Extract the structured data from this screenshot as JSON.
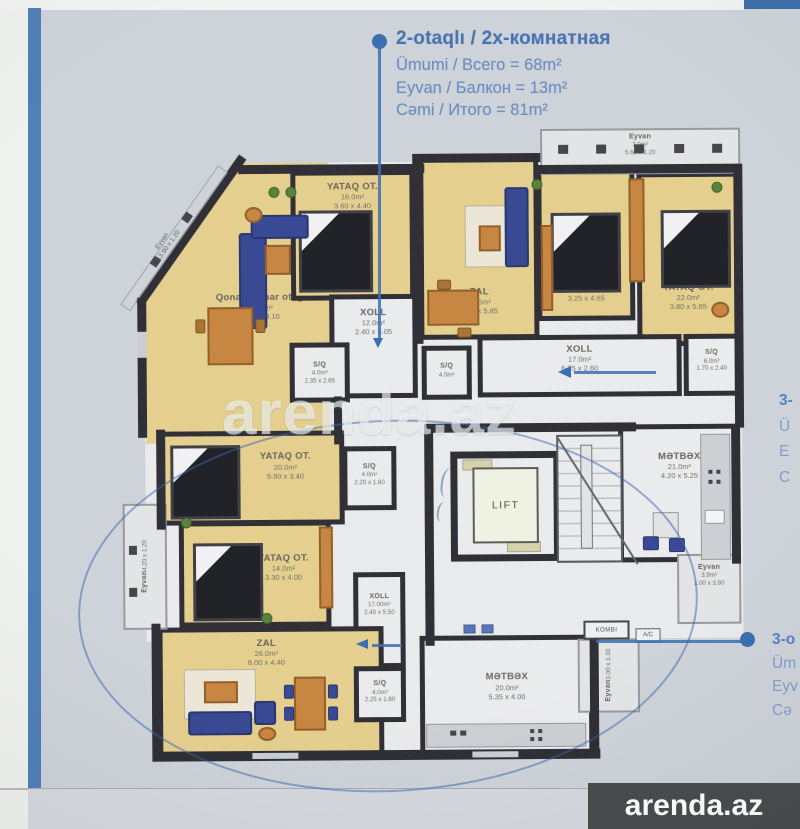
{
  "callouts": {
    "unit2": {
      "title": "2-otaqlı / 2х-комнатная",
      "line1": "Ümumi / Всего = 68m²",
      "line2": "Eyvan / Балкон = 13m²",
      "line3": "Cəmi / Итого = 81m²"
    },
    "unit3_right": {
      "line1": "3-",
      "line2": "Ü",
      "line3": "E",
      "line4": "C"
    },
    "unit3_bottom": {
      "line1": "3-o",
      "line2": "Üm",
      "line3": "Eyv",
      "line4": "Cə"
    }
  },
  "watermark": {
    "text": "arenda.az"
  },
  "logo": {
    "text": "arenda.az"
  },
  "plan": {
    "labels": {
      "lift": "LIFT",
      "kombi": "KOMBI",
      "ac": "A/C"
    },
    "accent_blue": "#2e66ad",
    "rooms": {
      "qonaq": {
        "name": "Qonaq-Nahar otağı",
        "area": "31.0m²",
        "dims": "5.50 x 9.10"
      },
      "yataq_left": {
        "name": "YATAQ OT.",
        "area": "16.0m²",
        "dims": "3.60 x 4.40"
      },
      "xoll_12": {
        "name": "XOLL",
        "area": "12.0m²",
        "dims": "2.40 x 5.05"
      },
      "sq_left": {
        "name": "S/Q",
        "area": "4.0m²",
        "dims": "2.35 x 2.65"
      },
      "zal_top": {
        "name": "ZAL",
        "area": "20.5m²",
        "dims": "4.00 x 5.85"
      },
      "sq_mid": {
        "name": "S/Q",
        "area": "4.0m²"
      },
      "yataq_mid": {
        "name": "YATAQ OT.",
        "area": "16.0m²",
        "dims": "3.25 x 4.65"
      },
      "yataq_right": {
        "name": "YATAQ OT.",
        "area": "22.0m²",
        "dims": "3.80 x 5.65"
      },
      "eyvan_top": {
        "name": "Eyvan",
        "area": "7.0m²",
        "dims": "5.60 x 1.20"
      },
      "xoll_17_top": {
        "name": "XOLL",
        "area": "17.0m²",
        "dims": "6.75 x 2.60"
      },
      "sq_right": {
        "name": "S/Q",
        "area": "6.0m²",
        "dims": "1.70 x 2.40"
      },
      "metbex_21": {
        "name": "MƏTBƏX",
        "area": "21.0m²",
        "dims": "4.20 x 5.25"
      },
      "eyvan_right": {
        "name": "Eyvan",
        "area": "3.9m²",
        "dims": "1.00 x 3.90"
      },
      "yataq_20": {
        "name": "YATAQ OT.",
        "area": "20.0m²",
        "dims": "5.90 x 3.40"
      },
      "sq_b1": {
        "name": "S/Q",
        "area": "4.0m²",
        "dims": "2.20 x 1.80"
      },
      "yataq_14": {
        "name": "YATAQ OT.",
        "area": "14.0m²",
        "dims": "3.30 x 4.00"
      },
      "xoll_17_b": {
        "name": "XOLL",
        "area": "17.00m²",
        "dims": "2.40 x 5.50"
      },
      "zal_26": {
        "name": "ZAL",
        "area": "26.0m²",
        "dims": "6.00 x 4.40"
      },
      "sq_b2": {
        "name": "S/Q",
        "area": "4.0m²",
        "dims": "2.25 x 1.80"
      },
      "metbex_20": {
        "name": "MƏTBƏX",
        "area": "20.0m²",
        "dims": "5.35 x 4.00"
      },
      "eyvan_left": {
        "name": "Eyvan",
        "dims": "4.20 x 1.20"
      },
      "eyvan_br": {
        "name": "Eyvan",
        "dims": "3.00 x 1.30"
      },
      "eyvan_diag": {
        "name": "Eyvan",
        "dims": "13.90 x 1.20"
      }
    }
  }
}
